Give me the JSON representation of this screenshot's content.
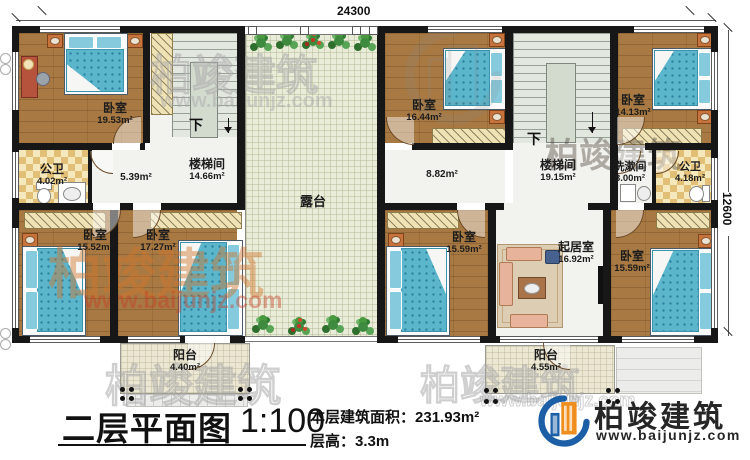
{
  "dimensions": {
    "top": "24300",
    "right": "12600"
  },
  "stairs": {
    "left_down": "下",
    "right_down": "下"
  },
  "rooms": {
    "bedroom_tl": {
      "name": "卧室",
      "area": "19.53m²"
    },
    "bath_tl": {
      "name": "公卫",
      "area": "4.02m²"
    },
    "hall_l": {
      "area": "5.39m²"
    },
    "stair_l": {
      "name": "楼梯间",
      "area": "14.66m²"
    },
    "terrace": {
      "name": "露台"
    },
    "bedroom_r1": {
      "name": "卧室",
      "area": "16.44m²"
    },
    "hall_r": {
      "area": "8.82m²"
    },
    "stair_r": {
      "name": "楼梯间",
      "area": "19.15m²"
    },
    "washroom": {
      "name": "洗漱间",
      "area": "3.00m²"
    },
    "bath_r": {
      "name": "公卫",
      "area": "4.18m²"
    },
    "bedroom_r2": {
      "name": "卧室",
      "area": "14.13m²"
    },
    "bedroom_bl": {
      "name": "卧室",
      "area": "15.52m²"
    },
    "bedroom_bl2": {
      "name": "卧室",
      "area": "17.27m²"
    },
    "balcony_l": {
      "name": "阳台",
      "area": "4.40m²"
    },
    "bedroom_bm": {
      "name": "卧室",
      "area": "15.59m²"
    },
    "living": {
      "name": "起居室",
      "area": "16.92m²"
    },
    "bedroom_br": {
      "name": "卧室",
      "area": "15.59m²"
    },
    "balcony_r": {
      "name": "阳台",
      "area": "4.55m²"
    }
  },
  "titleblock": {
    "title": "二层平面图",
    "scale": "1:100",
    "area_label": "本层建筑面积：",
    "area_value": "231.93m²",
    "height_label": "层高：",
    "height_value": "3.3m"
  },
  "logo": {
    "company": "柏竣建筑",
    "website": "www.baijunjz.com"
  },
  "watermark": {
    "company": "柏竣建筑",
    "website": "www.baijunjz.com"
  },
  "colors": {
    "wall": "#171717",
    "wood_floor": "#a87943",
    "bed_blue": "#5bb5cb",
    "tile_checker": "#e2bf77",
    "terrace_floor": "#e9ecd8",
    "logo_blue": "#1d5fa6",
    "logo_orange": "#ef8e1d",
    "watermark_orange": "#d0762c"
  }
}
